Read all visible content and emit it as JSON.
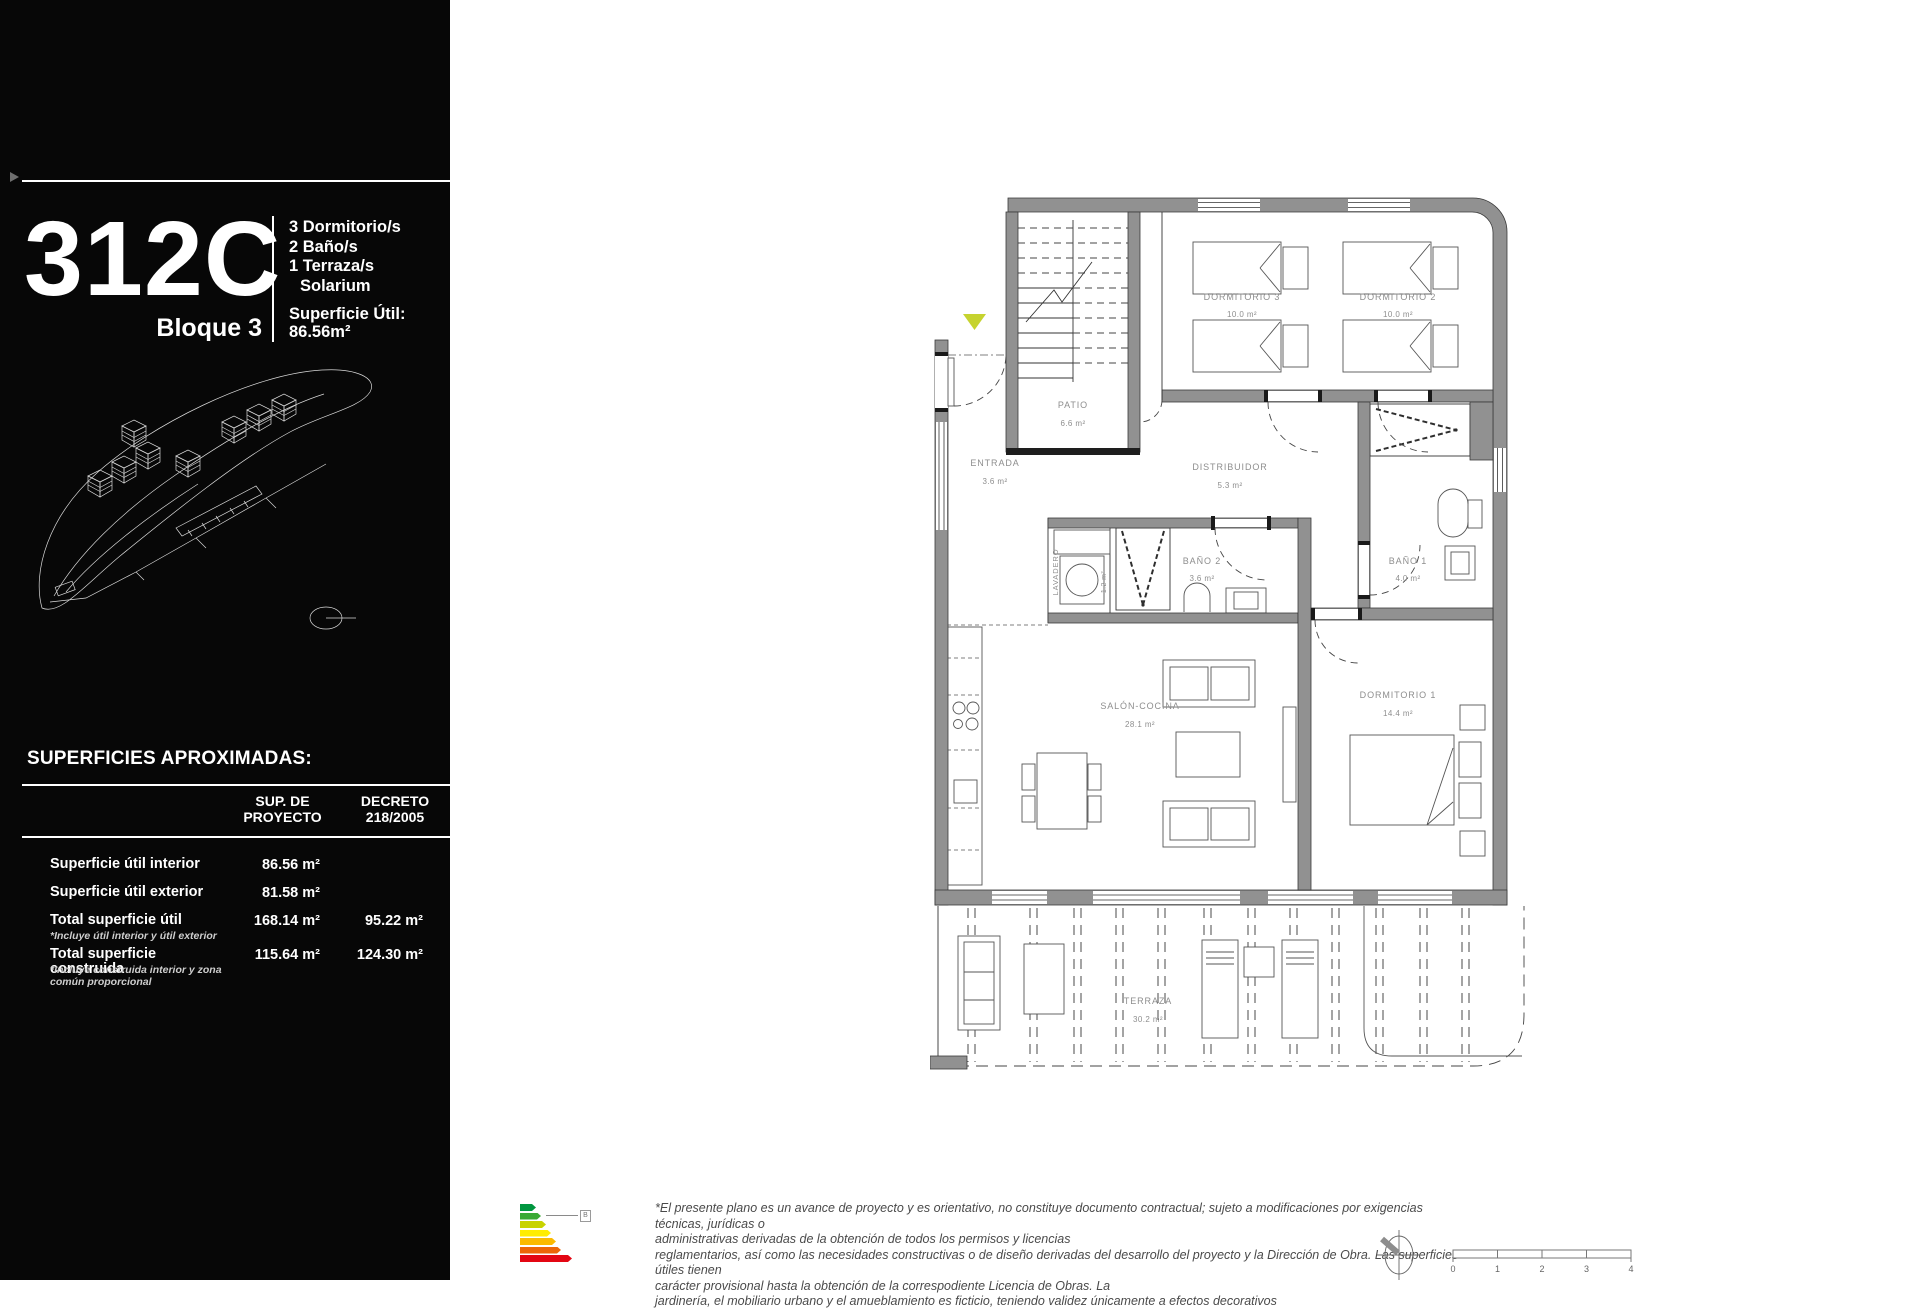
{
  "sidebar": {
    "unit_code": "312C",
    "block": "Bloque 3",
    "features": [
      "3 Dormitorio/s",
      "2 Baño/s",
      "1 Terraza/s",
      "Solarium"
    ],
    "superficie_util_label": "Superficie Útil:",
    "superficie_util_value": "86.56m²",
    "surfaces": {
      "title": "SUPERFICIES APROXIMADAS:",
      "columns": [
        "SUP. DE\nPROYECTO",
        "DECRETO\n218/2005"
      ],
      "rows": [
        {
          "label": "Superficie útil interior",
          "note": "",
          "proyecto": "86.56 m²",
          "decreto": ""
        },
        {
          "label": "Superficie útil exterior",
          "note": "",
          "proyecto": "81.58 m²",
          "decreto": ""
        },
        {
          "label": "Total superficie útil",
          "note": "*Incluye útil interior y útil exterior",
          "proyecto": "168.14 m²",
          "decreto": "95.22 m²"
        },
        {
          "label": "Total superficie construida",
          "note": "*Incluye construida interior y zona común proporcional",
          "proyecto": "115.64 m²",
          "decreto": "124.30 m²"
        }
      ]
    }
  },
  "plan": {
    "rooms": [
      {
        "name": "ENTRADA",
        "area": "3.6 m²"
      },
      {
        "name": "PATIO",
        "area": "6.6 m²"
      },
      {
        "name": "DISTRIBUIDOR",
        "area": "5.3 m²"
      },
      {
        "name": "DORMITORIO 3",
        "area": "10.0 m²"
      },
      {
        "name": "DORMITORIO 2",
        "area": "10.0 m²"
      },
      {
        "name": "BAÑO 2",
        "area": "3.6 m²"
      },
      {
        "name": "LAVADERO",
        "area": "1.2 m²"
      },
      {
        "name": "BAÑO 1",
        "area": "4.0 m²"
      },
      {
        "name": "SALÓN-COCINA",
        "area": "28.1 m²"
      },
      {
        "name": "DORMITORIO 1",
        "area": "14.4 m²"
      },
      {
        "name": "TERRAZA",
        "area": "30.2 m²"
      }
    ]
  },
  "footer": {
    "energy_rating": "B",
    "disclaimer_lines": [
      "*El presente plano es un avance de proyecto y es orientativo, no constituye documento contractual; sujeto a modificaciones por exigencias técnicas, jurídicas o",
      "administrativas derivadas de la obtención de todos los permisos y licencias",
      "reglamentarios, así como las necesidades constructivas o de diseño derivadas del desarrollo del proyecto y la Dirección de Obra. Las superficies útiles tienen",
      "carácter provisional hasta la obtención de la correspodiente Licencia de Obras. La",
      "jardinería, el mobiliario urbano y el amueblamiento es ficticio, teniendo validez únicamente a efectos decorativos"
    ],
    "scale_labels": [
      "0",
      "1",
      "2",
      "3",
      "4"
    ]
  },
  "colors": {
    "panel_black": "#070707",
    "wall_gray": "#919191",
    "entrance_marker": "#c6d32f",
    "energy_scale": [
      "#00963f",
      "#3aaa35",
      "#c8d300",
      "#ffed00",
      "#fbba00",
      "#ec6608",
      "#e30613"
    ]
  }
}
